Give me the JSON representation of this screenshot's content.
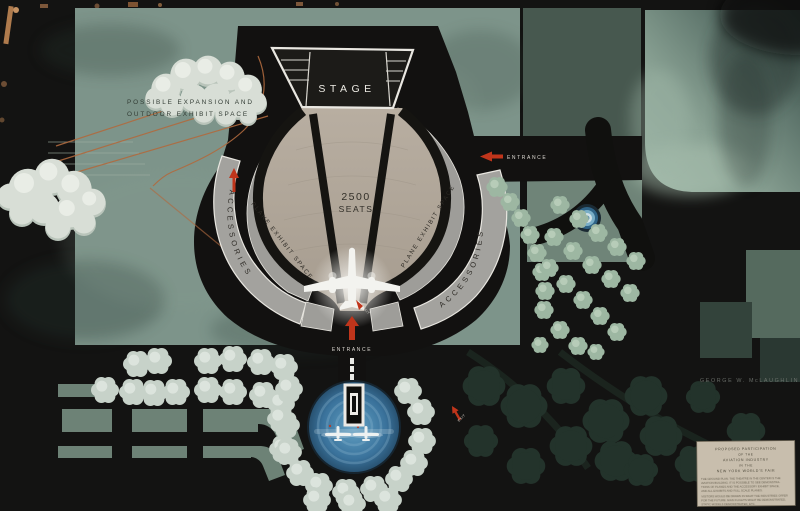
{
  "labels": {
    "stage": "STAGE",
    "seats_line1": "2500",
    "seats_line2": "SEATS",
    "expansion_line1": "POSSIBLE EXPANSION AND",
    "expansion_line2": "OUTDOOR EXHIBIT SPACE",
    "plane_exhibit_left": "PLANE EXHIBIT SPACE",
    "plane_exhibit_right": "PLANE EXHIBIT SPACE",
    "accessories_left": "ACCESSORIES",
    "accessories_right": "ACCESSORIES",
    "entrance_right": "ENTRANCE",
    "entrance_bottom": "ENTRANCE",
    "exit_center": "EXIT",
    "exit_right": "EXIT",
    "signature": "GEORGE W. McLAUGHLIN"
  },
  "plaque": {
    "line1": "PROPOSED PARTICIPATION",
    "line2": "OF THE",
    "line3": "AVIATION INDUSTRY",
    "line4": "IN THE",
    "line5": "NEW YORK WORLD'S FAIR",
    "body": [
      "THE GROUND PLAN.  THE THEATRE IN THE CENTER IS THE",
      "AVIATION BUILDING.  IT IS POSSIBLE TO SEE DEMONSTRA-",
      "TIONS OF PLANES AND THE ACCESSORY EXHIBIT SPACE,",
      "AND ALL EXHIBITS AND FULL SCALE PLANES.",
      "VISITORS WOULD BE DRAWN IN WHAT THE INDUSTRIES OFFER",
      "FOR THE FUTURE.  MAIN FLIGHTS MIGHT BE DEMONSTRATED,",
      "STATIC MODELS DEMONSTRATED, ETC."
    ]
  },
  "colors": {
    "board": "#131312",
    "field_green": "#7d948a",
    "mist_green": "#8fa89a",
    "dark_green": "#47584f",
    "seating_tan": "#b0a69a",
    "building_gray": "#a3a29e",
    "pond_blue": "#3f7da5",
    "accent_red": "#c0351b",
    "line_orange": "#b06a3e",
    "card_beige": "#c8bead",
    "ink_white": "#e9e7e1"
  }
}
